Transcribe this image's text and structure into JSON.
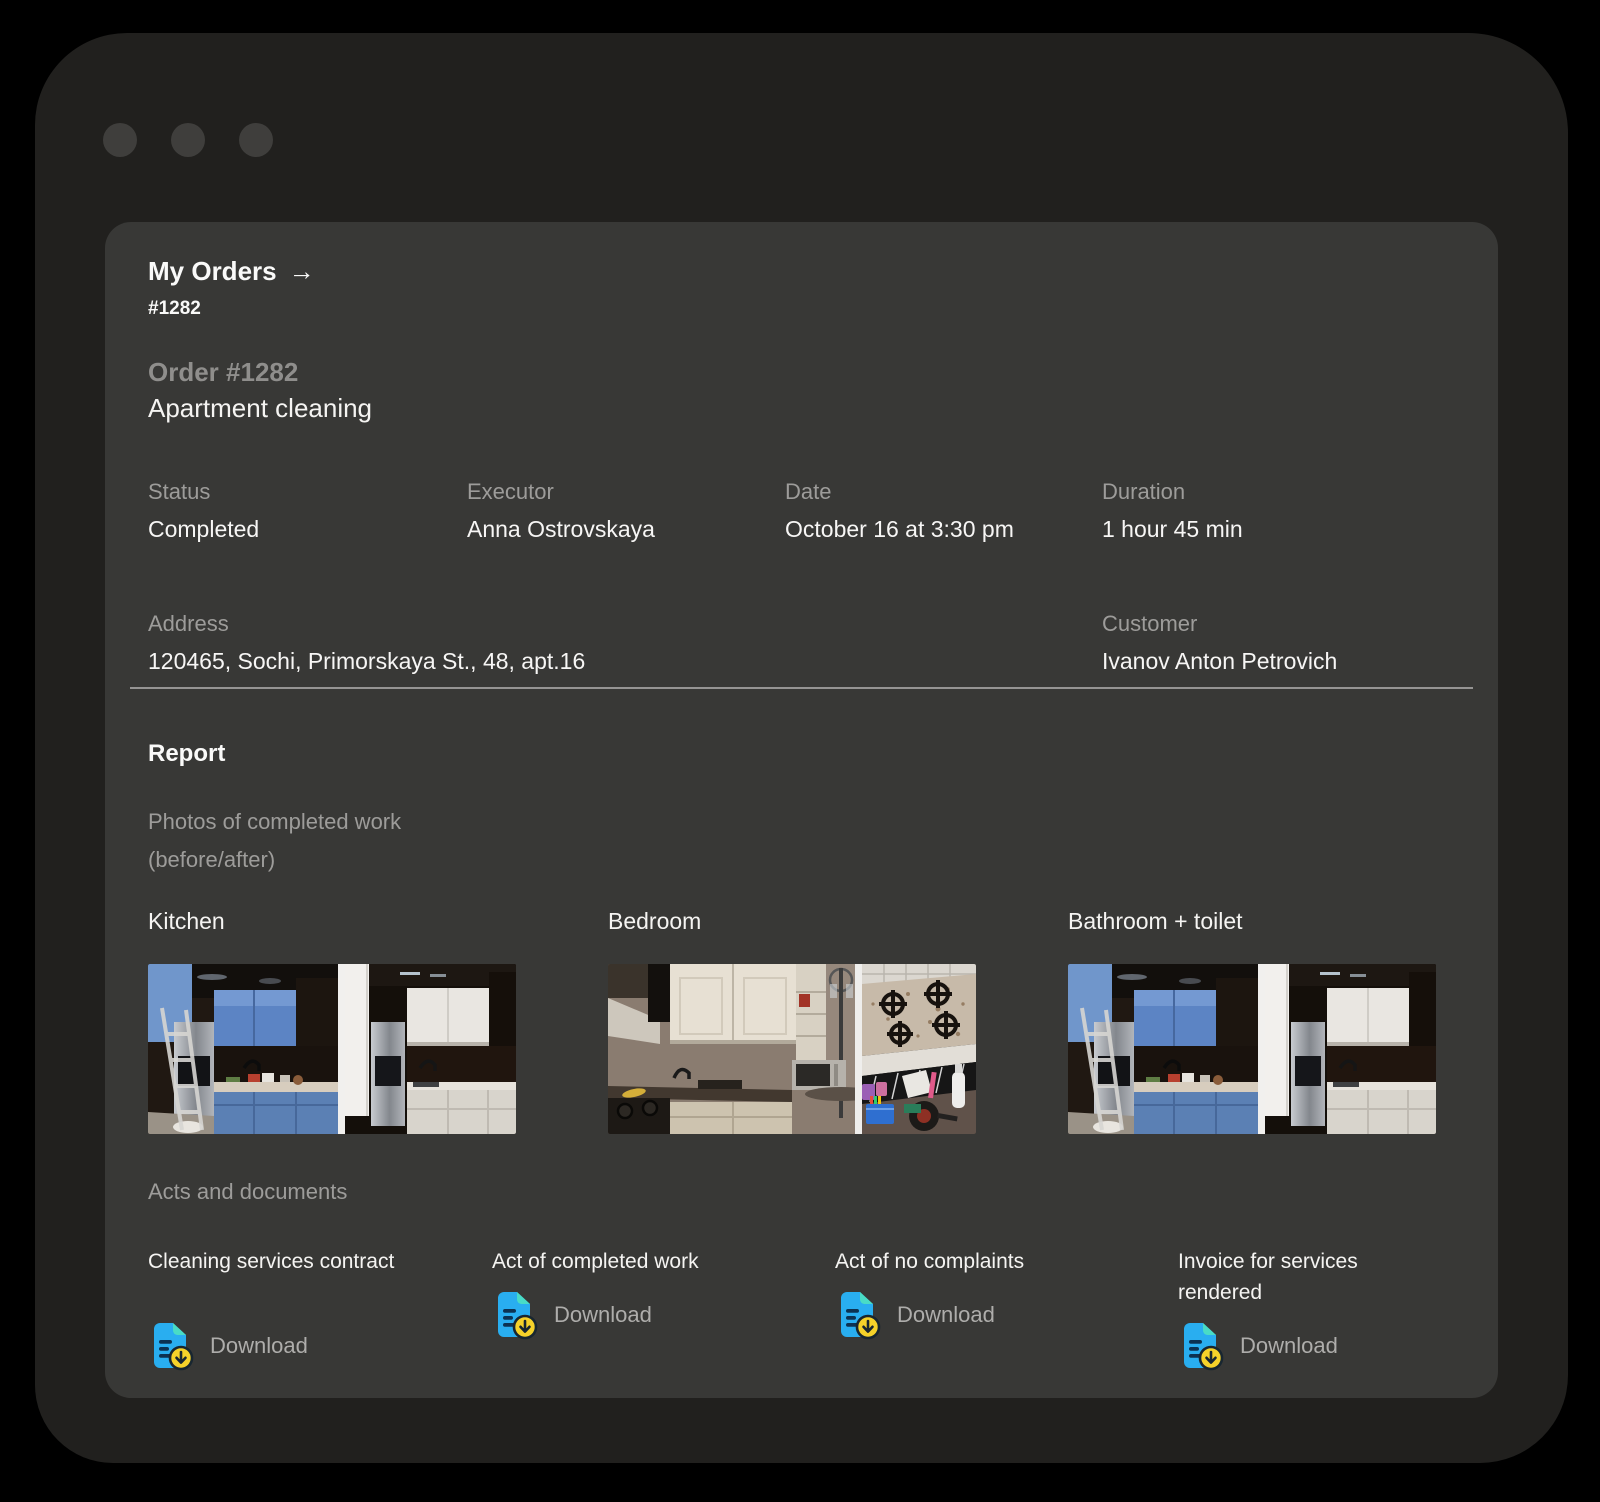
{
  "colors": {
    "accent_blue": "#29aef0",
    "accent_teal": "#49dcc6",
    "accent_yellow": "#f5d22a",
    "window_bg": "#21201e",
    "card_bg": "#383836",
    "text_primary": "#f7f6f5",
    "text_secondary": "#9d9c9a"
  },
  "breadcrumb": {
    "label": "My Orders",
    "arrow": "→",
    "current": "#1282"
  },
  "order": {
    "title": "Order #1282",
    "subtitle": "Apartment cleaning"
  },
  "fields": [
    {
      "label": "Status",
      "value": "Completed"
    },
    {
      "label": "Executor",
      "value": "Anna Ostrovskaya"
    },
    {
      "label": "Date",
      "value": "October 16 at 3:30 pm"
    },
    {
      "label": "Duration",
      "value": "1 hour 45 min"
    },
    {
      "label": "Address",
      "value": "120465, Sochi, Primorskaya St., 48, apt.16"
    },
    {
      "label": "Customer",
      "value": "Ivanov Anton Petrovich"
    }
  ],
  "report": {
    "heading": "Report",
    "photos_title": "Photos of completed work",
    "photos_subtitle": "(before/after)",
    "photo_groups": [
      {
        "label": "Kitchen"
      },
      {
        "label": "Bedroom"
      },
      {
        "label": "Bathroom + toilet"
      }
    ],
    "documents_heading": "Acts and documents",
    "documents": [
      {
        "title": "Cleaning services contract",
        "action": "Download"
      },
      {
        "title": "Act of completed work",
        "action": "Download"
      },
      {
        "title": "Act of no complaints",
        "action": "Download"
      },
      {
        "title": "Invoice for services rendered",
        "action": "Download"
      }
    ]
  }
}
